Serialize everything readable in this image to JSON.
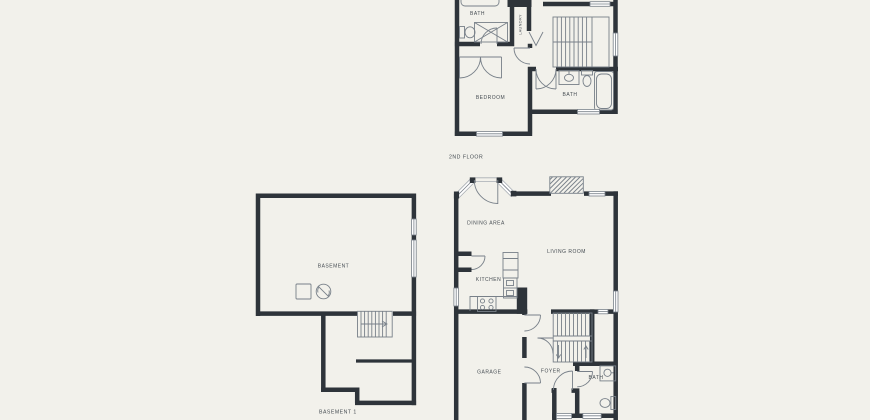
{
  "colors": {
    "background": "#f2f1eb",
    "wall": "#2e343a",
    "line": "#788089",
    "line_light": "#a8aeb4",
    "text": "#454c52",
    "white": "#ffffff"
  },
  "floors": {
    "second": {
      "title": "2ND FLOOR",
      "rooms": {
        "bath_top": "BATH",
        "laundry": "LAUNDRY",
        "bedroom": "BEDROOM",
        "bath": "BATH"
      }
    },
    "basement": {
      "title": "BASEMENT 1",
      "rooms": {
        "basement": "BASEMENT"
      }
    },
    "first": {
      "rooms": {
        "dining": "DINING AREA",
        "living": "LIVING ROOM",
        "kitchen": "KITCHEN",
        "garage": "GARAGE",
        "foyer": "FOYER",
        "bath": "BATH"
      }
    }
  }
}
